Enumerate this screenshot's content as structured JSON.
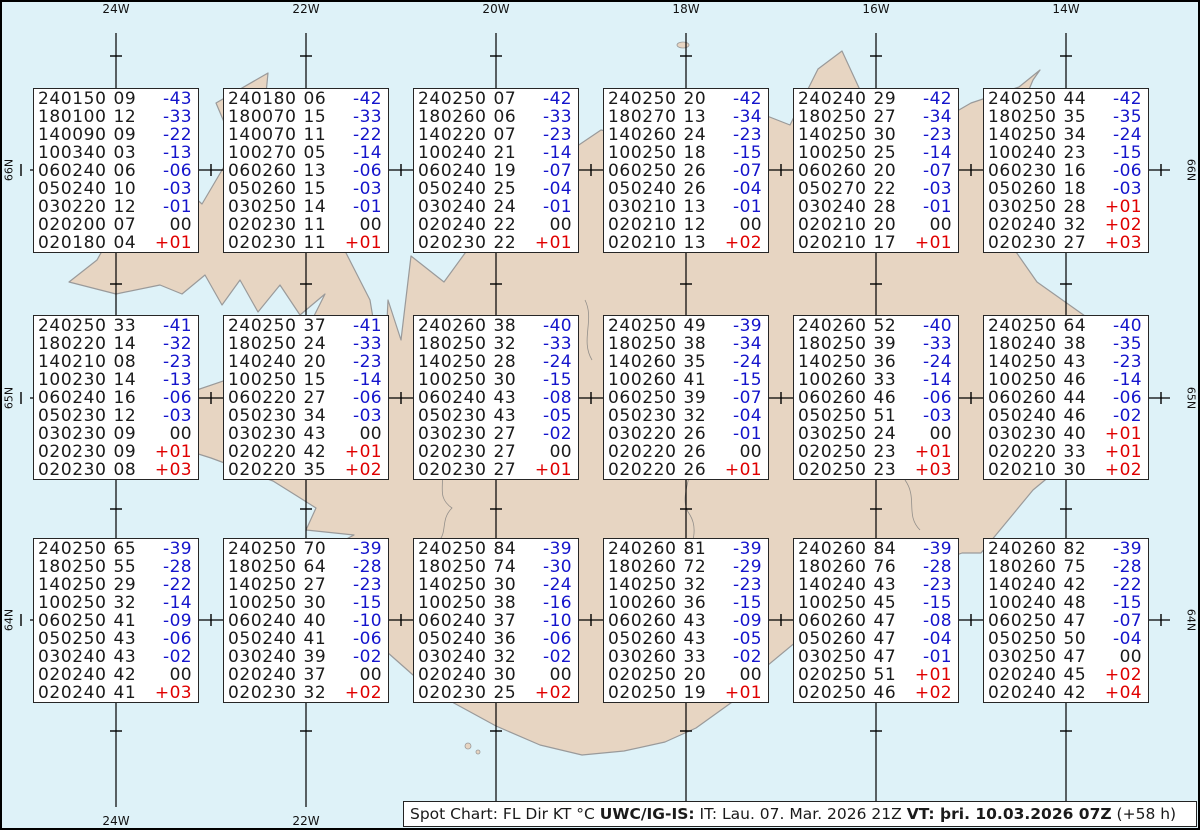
{
  "chart_title": "Spot Chart",
  "caption": {
    "segments": [
      {
        "text": "Spot Chart: FL Dir KT °C ",
        "bold": false
      },
      {
        "text": "UWC/IG-IS:",
        "bold": true
      },
      {
        "text": " IT: Lau. 07. Mar. 2026 21Z ",
        "bold": false
      },
      {
        "text": "VT: þri. 10.03.2026 07Z",
        "bold": true
      },
      {
        "text": " (+58 h)",
        "bold": false
      }
    ]
  },
  "graticule": {
    "lon_labels": [
      "24W",
      "22W",
      "20W",
      "18W",
      "16W",
      "14W"
    ],
    "lat_labels": [
      "66N",
      "65N",
      "64N"
    ]
  },
  "colors": {
    "water": "#def2f8",
    "land": "#e7d5c2",
    "coast": "#9a9a9a",
    "grid": "#000000",
    "temp_negative": "#1414cc",
    "temp_positive": "#e00000",
    "temp_zero": "#1a1a1a"
  },
  "column_legend": [
    "FL",
    "Dir",
    "KT",
    "°C"
  ],
  "spot_boxes": [
    {
      "id": "r1c1",
      "lines": [
        [
          "240150",
          "09",
          "-43"
        ],
        [
          "180100",
          "12",
          "-33"
        ],
        [
          "140090",
          "09",
          "-22"
        ],
        [
          "100340",
          "03",
          "-13"
        ],
        [
          "060240",
          "06",
          "-06"
        ],
        [
          "050240",
          "10",
          "-03"
        ],
        [
          "030220",
          "12",
          "-01"
        ],
        [
          "020200",
          "07",
          "00"
        ],
        [
          "020180",
          "04",
          "+01"
        ]
      ]
    },
    {
      "id": "r1c2",
      "lines": [
        [
          "240180",
          "06",
          "-42"
        ],
        [
          "180070",
          "15",
          "-33"
        ],
        [
          "140070",
          "11",
          "-22"
        ],
        [
          "100270",
          "05",
          "-14"
        ],
        [
          "060260",
          "13",
          "-06"
        ],
        [
          "050260",
          "15",
          "-03"
        ],
        [
          "030250",
          "14",
          "-01"
        ],
        [
          "020230",
          "11",
          "00"
        ],
        [
          "020230",
          "11",
          "+01"
        ]
      ]
    },
    {
      "id": "r1c3",
      "lines": [
        [
          "240250",
          "07",
          "-42"
        ],
        [
          "180260",
          "06",
          "-33"
        ],
        [
          "140220",
          "07",
          "-23"
        ],
        [
          "100240",
          "21",
          "-14"
        ],
        [
          "060240",
          "19",
          "-07"
        ],
        [
          "050240",
          "25",
          "-04"
        ],
        [
          "030240",
          "24",
          "-01"
        ],
        [
          "020240",
          "22",
          "00"
        ],
        [
          "020230",
          "22",
          "+01"
        ]
      ]
    },
    {
      "id": "r1c4",
      "lines": [
        [
          "240250",
          "20",
          "-42"
        ],
        [
          "180270",
          "13",
          "-34"
        ],
        [
          "140260",
          "24",
          "-23"
        ],
        [
          "100250",
          "18",
          "-15"
        ],
        [
          "060250",
          "26",
          "-07"
        ],
        [
          "050240",
          "26",
          "-04"
        ],
        [
          "030210",
          "13",
          "-01"
        ],
        [
          "020210",
          "12",
          "00"
        ],
        [
          "020210",
          "13",
          "+02"
        ]
      ]
    },
    {
      "id": "r1c5",
      "lines": [
        [
          "240240",
          "29",
          "-42"
        ],
        [
          "180250",
          "27",
          "-34"
        ],
        [
          "140250",
          "30",
          "-23"
        ],
        [
          "100250",
          "25",
          "-14"
        ],
        [
          "060260",
          "20",
          "-07"
        ],
        [
          "050270",
          "22",
          "-03"
        ],
        [
          "030240",
          "28",
          "-01"
        ],
        [
          "020210",
          "20",
          "00"
        ],
        [
          "020210",
          "17",
          "+01"
        ]
      ]
    },
    {
      "id": "r1c6",
      "lines": [
        [
          "240250",
          "44",
          "-42"
        ],
        [
          "180250",
          "35",
          "-35"
        ],
        [
          "140250",
          "34",
          "-24"
        ],
        [
          "100240",
          "23",
          "-15"
        ],
        [
          "060230",
          "16",
          "-06"
        ],
        [
          "050260",
          "18",
          "-03"
        ],
        [
          "030250",
          "28",
          "+01"
        ],
        [
          "020240",
          "32",
          "+02"
        ],
        [
          "020230",
          "27",
          "+03"
        ]
      ]
    },
    {
      "id": "r2c1",
      "lines": [
        [
          "240250",
          "33",
          "-41"
        ],
        [
          "180220",
          "14",
          "-32"
        ],
        [
          "140210",
          "08",
          "-23"
        ],
        [
          "100230",
          "14",
          "-13"
        ],
        [
          "060240",
          "16",
          "-06"
        ],
        [
          "050230",
          "12",
          "-03"
        ],
        [
          "030230",
          "09",
          "00"
        ],
        [
          "020230",
          "09",
          "+01"
        ],
        [
          "020230",
          "08",
          "+03"
        ]
      ]
    },
    {
      "id": "r2c2",
      "lines": [
        [
          "240250",
          "37",
          "-41"
        ],
        [
          "180250",
          "24",
          "-33"
        ],
        [
          "140240",
          "20",
          "-23"
        ],
        [
          "100250",
          "15",
          "-14"
        ],
        [
          "060220",
          "27",
          "-06"
        ],
        [
          "050230",
          "34",
          "-03"
        ],
        [
          "030230",
          "43",
          "00"
        ],
        [
          "020220",
          "42",
          "+01"
        ],
        [
          "020220",
          "35",
          "+02"
        ]
      ]
    },
    {
      "id": "r2c3",
      "lines": [
        [
          "240260",
          "38",
          "-40"
        ],
        [
          "180250",
          "32",
          "-33"
        ],
        [
          "140250",
          "28",
          "-24"
        ],
        [
          "100250",
          "30",
          "-15"
        ],
        [
          "060240",
          "43",
          "-08"
        ],
        [
          "050230",
          "43",
          "-05"
        ],
        [
          "030230",
          "27",
          "-02"
        ],
        [
          "020230",
          "27",
          "00"
        ],
        [
          "020230",
          "27",
          "+01"
        ]
      ]
    },
    {
      "id": "r2c4",
      "lines": [
        [
          "240250",
          "49",
          "-39"
        ],
        [
          "180250",
          "38",
          "-34"
        ],
        [
          "140260",
          "35",
          "-24"
        ],
        [
          "100260",
          "41",
          "-15"
        ],
        [
          "060250",
          "39",
          "-07"
        ],
        [
          "050230",
          "32",
          "-04"
        ],
        [
          "030220",
          "26",
          "-01"
        ],
        [
          "020220",
          "26",
          "00"
        ],
        [
          "020220",
          "26",
          "+01"
        ]
      ]
    },
    {
      "id": "r2c5",
      "lines": [
        [
          "240260",
          "52",
          "-40"
        ],
        [
          "180250",
          "39",
          "-33"
        ],
        [
          "140250",
          "36",
          "-24"
        ],
        [
          "100260",
          "33",
          "-14"
        ],
        [
          "060260",
          "46",
          "-06"
        ],
        [
          "050250",
          "51",
          "-03"
        ],
        [
          "030250",
          "24",
          "00"
        ],
        [
          "020250",
          "23",
          "+01"
        ],
        [
          "020250",
          "23",
          "+03"
        ]
      ]
    },
    {
      "id": "r2c6",
      "lines": [
        [
          "240250",
          "64",
          "-40"
        ],
        [
          "180240",
          "38",
          "-35"
        ],
        [
          "140250",
          "43",
          "-23"
        ],
        [
          "100250",
          "46",
          "-14"
        ],
        [
          "060260",
          "44",
          "-06"
        ],
        [
          "050240",
          "46",
          "-02"
        ],
        [
          "030230",
          "40",
          "+01"
        ],
        [
          "020220",
          "33",
          "+01"
        ],
        [
          "020210",
          "30",
          "+02"
        ]
      ]
    },
    {
      "id": "r3c1",
      "lines": [
        [
          "240250",
          "65",
          "-39"
        ],
        [
          "180250",
          "55",
          "-28"
        ],
        [
          "140250",
          "29",
          "-22"
        ],
        [
          "100250",
          "32",
          "-14"
        ],
        [
          "060250",
          "41",
          "-09"
        ],
        [
          "050250",
          "43",
          "-06"
        ],
        [
          "030240",
          "43",
          "-02"
        ],
        [
          "020240",
          "42",
          "00"
        ],
        [
          "020240",
          "41",
          "+03"
        ]
      ]
    },
    {
      "id": "r3c2",
      "lines": [
        [
          "240250",
          "70",
          "-39"
        ],
        [
          "180250",
          "64",
          "-28"
        ],
        [
          "140250",
          "27",
          "-23"
        ],
        [
          "100250",
          "30",
          "-15"
        ],
        [
          "060240",
          "40",
          "-10"
        ],
        [
          "050240",
          "41",
          "-06"
        ],
        [
          "030240",
          "39",
          "-02"
        ],
        [
          "020240",
          "37",
          "00"
        ],
        [
          "020230",
          "32",
          "+02"
        ]
      ]
    },
    {
      "id": "r3c3",
      "lines": [
        [
          "240250",
          "84",
          "-39"
        ],
        [
          "180250",
          "74",
          "-30"
        ],
        [
          "140250",
          "30",
          "-24"
        ],
        [
          "100250",
          "38",
          "-16"
        ],
        [
          "060240",
          "37",
          "-10"
        ],
        [
          "050240",
          "36",
          "-06"
        ],
        [
          "030240",
          "32",
          "-02"
        ],
        [
          "020240",
          "30",
          "00"
        ],
        [
          "020230",
          "25",
          "+02"
        ]
      ]
    },
    {
      "id": "r3c4",
      "lines": [
        [
          "240260",
          "81",
          "-39"
        ],
        [
          "180260",
          "72",
          "-29"
        ],
        [
          "140250",
          "32",
          "-23"
        ],
        [
          "100260",
          "36",
          "-15"
        ],
        [
          "060260",
          "43",
          "-09"
        ],
        [
          "050260",
          "43",
          "-05"
        ],
        [
          "030260",
          "33",
          "-02"
        ],
        [
          "020250",
          "20",
          "00"
        ],
        [
          "020250",
          "19",
          "+01"
        ]
      ]
    },
    {
      "id": "r3c5",
      "lines": [
        [
          "240260",
          "84",
          "-39"
        ],
        [
          "180260",
          "76",
          "-28"
        ],
        [
          "140240",
          "43",
          "-23"
        ],
        [
          "100250",
          "45",
          "-15"
        ],
        [
          "060260",
          "47",
          "-08"
        ],
        [
          "050260",
          "47",
          "-04"
        ],
        [
          "030250",
          "47",
          "-01"
        ],
        [
          "020250",
          "51",
          "+01"
        ],
        [
          "020250",
          "46",
          "+02"
        ]
      ]
    },
    {
      "id": "r3c6",
      "lines": [
        [
          "240260",
          "82",
          "-39"
        ],
        [
          "180260",
          "75",
          "-28"
        ],
        [
          "140240",
          "42",
          "-22"
        ],
        [
          "100240",
          "48",
          "-15"
        ],
        [
          "060250",
          "47",
          "-07"
        ],
        [
          "050250",
          "50",
          "-04"
        ],
        [
          "030250",
          "47",
          "00"
        ],
        [
          "020240",
          "45",
          "+02"
        ],
        [
          "020240",
          "42",
          "+04"
        ]
      ]
    }
  ]
}
